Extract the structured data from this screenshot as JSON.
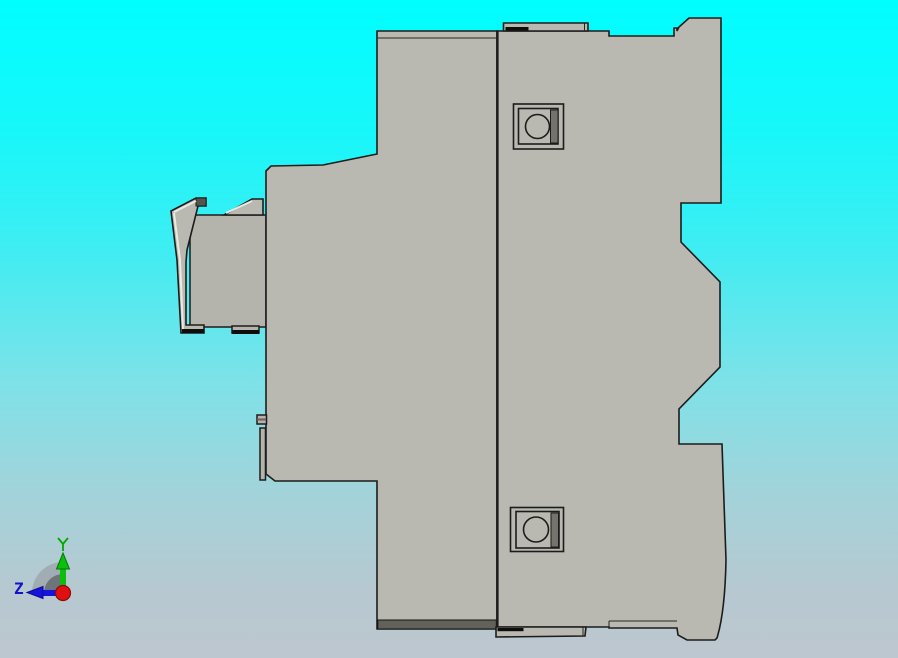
{
  "viewport": {
    "kind": "cad-3d-view",
    "background_top_color": "#00feff",
    "background_bottom_color": "#bdc7cf",
    "part_fill_color": "#b9b9b1",
    "part_edge_color": "#1c1c1c"
  },
  "part": {
    "view": "side-profile",
    "features": {
      "mounting_hole_top": "square boss with circular hole",
      "mounting_hole_bottom": "square boss with circular hole",
      "left_clip": "spring clip hook with two angled fins"
    }
  },
  "orientation_triad": {
    "y_axis": {
      "label": "Y",
      "color": "#00b000",
      "direction": "up"
    },
    "z_axis": {
      "label": "Z",
      "color": "#1212cc",
      "direction": "left"
    },
    "x_axis": {
      "label": "",
      "color": "#e01010",
      "direction": "toward-viewer"
    }
  }
}
